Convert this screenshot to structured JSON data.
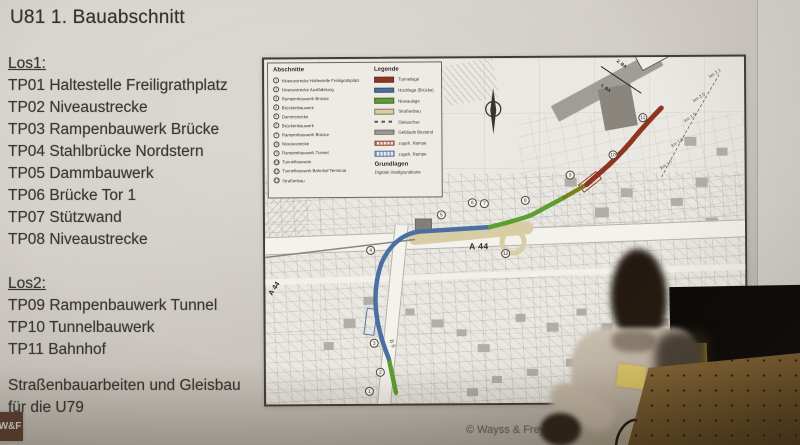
{
  "slide": {
    "title": "U81 1. Bauabschnitt",
    "los1_heading": "Los1:",
    "los1_items": [
      "TP01 Haltestelle Freiligrathplatz",
      "TP02 Niveaustrecke",
      "TP03 Rampenbauwerk Brücke",
      "TP04 Stahlbrücke Nordstern",
      "TP05 Dammbauwerk",
      "TP06 Brücke Tor 1",
      "TP07 Stützwand",
      "TP08 Niveaustrecke"
    ],
    "los2_heading": "Los2:",
    "los2_items": [
      "TP09 Rampenbauwerk Tunnel",
      "TP10 Tunnelbauwerk",
      "TP11 Bahnhof"
    ],
    "note_line1": "Straßenbauarbeiten und Gleisbau",
    "note_line2": "für die U79",
    "logo_text": "W&F",
    "copyright": "© Wayss & Freytag Ingenieurbau"
  },
  "map": {
    "abschnitte_title": "Abschnitte",
    "abschnitte_items": [
      {
        "num": "1",
        "label": "Niveaustrecke Haltestelle Freiligrathplatz"
      },
      {
        "num": "2",
        "label": "Niveaustrecke Ausfädelung"
      },
      {
        "num": "3",
        "label": "Rampenbauwerk Brücke"
      },
      {
        "num": "4",
        "label": "Brückenbauwerk"
      },
      {
        "num": "5",
        "label": "Dammstrecke"
      },
      {
        "num": "6",
        "label": "Brückenbauwerk"
      },
      {
        "num": "7",
        "label": "Rampenbauwerk Brücke"
      },
      {
        "num": "8",
        "label": "Niveaustrecke"
      },
      {
        "num": "9",
        "label": "Rampenbauwerk Tunnel"
      },
      {
        "num": "10",
        "label": "Tunnelbauwerk"
      },
      {
        "num": "11",
        "label": "Tunnelbauwerk Bahnhof Terminal"
      },
      {
        "num": "12",
        "label": "Straßenbau"
      }
    ],
    "legende_title": "Legende",
    "legende_entries": [
      {
        "label": "Tunnellage"
      },
      {
        "label": "Hochlage (Brücke)"
      },
      {
        "label": "Niveaulage"
      },
      {
        "label": "Straßenbau"
      },
      {
        "label": "Gleisachse"
      },
      {
        "label": "Gebäude Bestand"
      },
      {
        "label": "zugeh. Rampe"
      },
      {
        "label": "zugeh. Rampe"
      }
    ],
    "grundlagen_title": "Grundlagen",
    "grundlagen_text": "Digitale Stadtgrundkarte",
    "labels": {
      "a44": "A 44",
      "a44_rot": "A 44",
      "b8": "B 8",
      "north": "N",
      "ba1": "1. BA",
      "ba2": "2. BA"
    },
    "km_labels": [
      "km 2,1",
      "km 2,0",
      "km 1,9",
      "km 1,8",
      "km 1,7"
    ],
    "route_markers": [
      "1",
      "2",
      "3",
      "4",
      "5",
      "6",
      "7",
      "8",
      "9",
      "10",
      "11",
      "12"
    ]
  },
  "colors": {
    "tunnel_red": "#8e3420",
    "bridge_blue": "#4a6fa0",
    "niveau_green": "#5d9e32",
    "ramp_olive": "#7a7f1e",
    "strassenbau_tan": "#d9cda6",
    "bestand_gray": "#8f8d89",
    "logo_brown": "#5c4130"
  }
}
